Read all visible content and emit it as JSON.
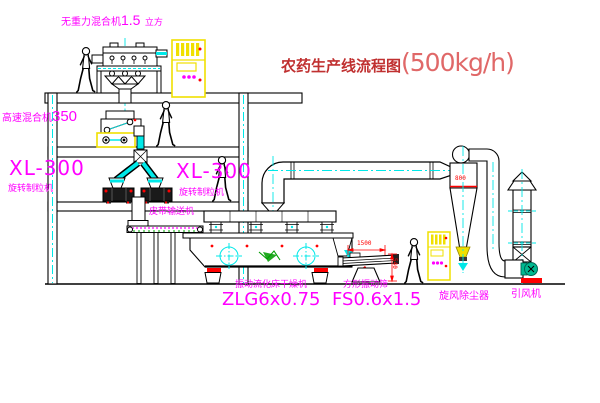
{
  "title": {
    "name": "农药生产线流程图",
    "capacity": "(500kg/h)"
  },
  "equipment": {
    "gravity_mixer": {
      "name": "无重力混合机",
      "size": "1.5",
      "unit": "立方"
    },
    "high_speed_mixer": {
      "name": "高速混合机",
      "model": "350"
    },
    "granulator_left": {
      "model": "XL-300",
      "name": "旋转制粒机"
    },
    "granulator_right": {
      "model": "XL-300",
      "name": "旋转制粒机"
    },
    "belt_conveyor": {
      "name": "皮带输送机"
    },
    "dryer": {
      "name": "振动流化床干燥机",
      "model": "ZLG6x0.75"
    },
    "sieve": {
      "name": "方形振动筛",
      "model": "FS0.6x1.5"
    },
    "cyclone": {
      "name": "旋风除尘器"
    },
    "fan": {
      "name": "引风机"
    }
  },
  "dimensions": {
    "cyclone_width": "800",
    "sieve_length": "1500",
    "sieve_height": "540"
  },
  "colors": {
    "label_magenta": "#ff00ff",
    "title_red": "#c03030",
    "capacity_red": "#e06868",
    "dimension_red": "#ff0000",
    "pipe_cyan": "#00e8e8",
    "cabinet_yellow": "#f0e000",
    "motor_teal": "#00b890"
  }
}
